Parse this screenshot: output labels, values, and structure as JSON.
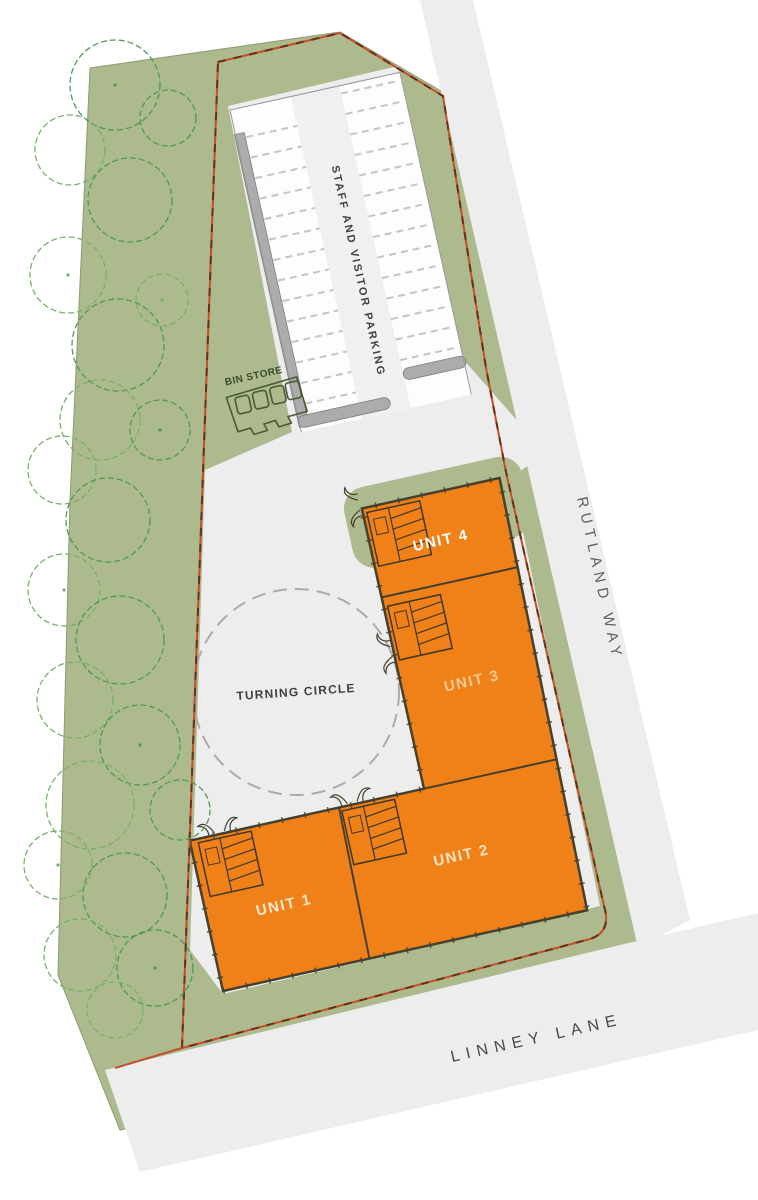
{
  "labels": {
    "parking": "STAFF AND VISITOR PARKING",
    "bin_store": "BIN STORE",
    "turning_circle": "TURNING CIRCLE",
    "unit_1": "UNIT 1",
    "unit_2": "UNIT 2",
    "unit_3": "UNIT 3",
    "unit_4": "UNIT 4",
    "road_right": "RUTLAND WAY",
    "road_bottom": "LINNEY LANE"
  },
  "colors": {
    "landscape_green": "#ADBA8E",
    "landscape_edge": "#8A9A72",
    "tree_outline_dark": "#4E9A55",
    "tree_outline_light": "#79B06F",
    "road_gray": "#EDEDEE",
    "building_fill": "#F08119",
    "building_outline": "#45402E",
    "boundary_red": "#C2502B",
    "boundary_dash": "#6B2F16",
    "curb_gray": "#ACACAC",
    "stall_line_gray": "#C4C4C4",
    "text_dark": "#3F3F3F",
    "road_text_gray": "#5F5F5F",
    "unit1_label": "#FAE9D0",
    "unit2_label": "#F8E3C4",
    "unit3_label": "#F5C992",
    "unit4_label": "#FFFFFF"
  }
}
